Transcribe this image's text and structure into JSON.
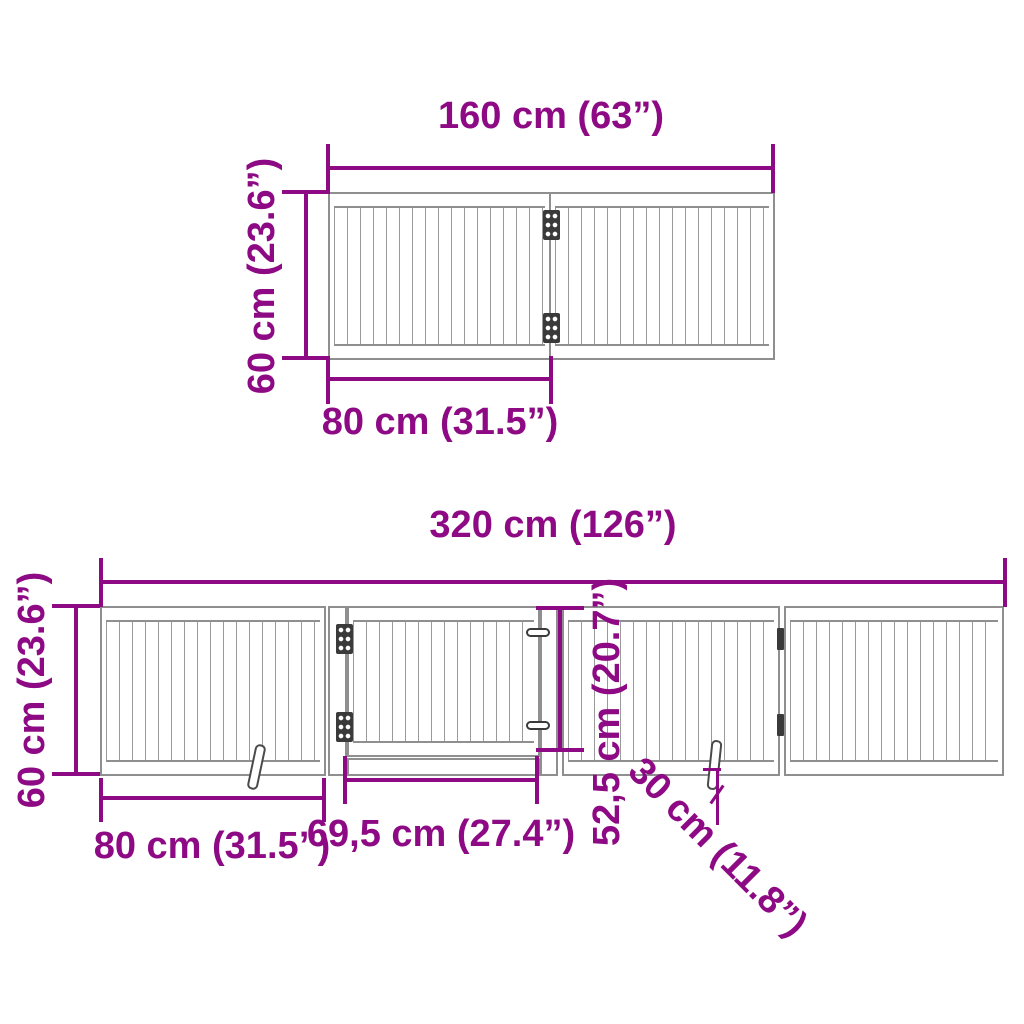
{
  "diagram": {
    "accent_color": "#8E0A84",
    "structure_color": "#8f8f8f",
    "top_view": {
      "width_label": "160 cm (63”)",
      "height_label": "60 cm (23.6”)",
      "panel_width_label": "80 cm (31.5”)"
    },
    "bottom_view": {
      "width_label": "320 cm (126”)",
      "height_label": "60 cm (23.6”)",
      "panel_width_label": "80 cm (31.5”)",
      "door_width_label": "69,5 cm (27.4”)",
      "door_height_label": "52,5 cm (20.7”)",
      "foot_length_label": "30 cm (11.8”)"
    }
  }
}
